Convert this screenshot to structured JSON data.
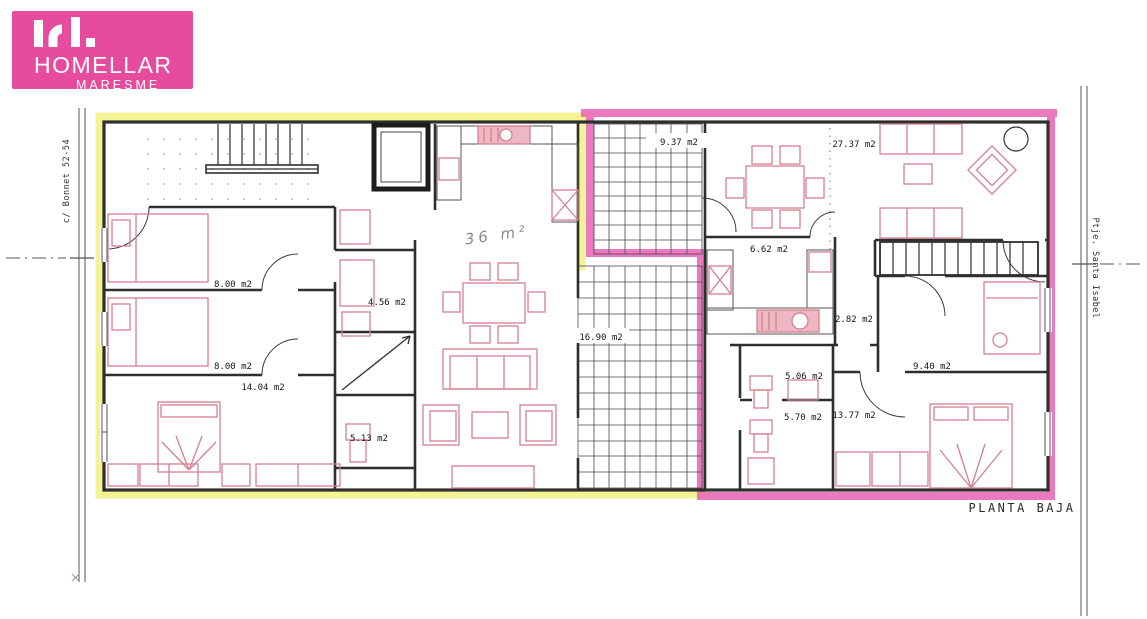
{
  "logo": {
    "monogram": "hl.",
    "brand": "HOMELLAR",
    "region": "MARESME",
    "bg_color": "#e74b9d"
  },
  "plan": {
    "caption": "PLANTA BAJA",
    "street_left": "c/ Bonnet 52-54",
    "street_right": "Ptje. Santa Isabel",
    "colors": {
      "left_apartment_highlight": "#f2f18f",
      "right_apartment_highlight": "#e761b4",
      "furniture": "#d5808e",
      "walls": "#2e2e2e"
    },
    "rooms": {
      "left": {
        "bedroom_top": "8.00 m2",
        "bedroom_mid": "8.00 m2",
        "bedroom_bottom": "14.04 m2",
        "room_mid": "4.56 m2",
        "bathroom": "5.13 m2",
        "living_handwritten": "36 m²"
      },
      "patios": {
        "top": "9.37 m2",
        "bottom": "16.90 m2"
      },
      "right": {
        "living": "27.37 m2",
        "kitchen": "6.62 m2",
        "hall": "2.82 m2",
        "bedroom_mid": "9.40 m2",
        "bath_top": "5.06 m2",
        "bath_bottom": "5.70 m2",
        "bedroom_bottom": "13.77 m2"
      }
    }
  }
}
